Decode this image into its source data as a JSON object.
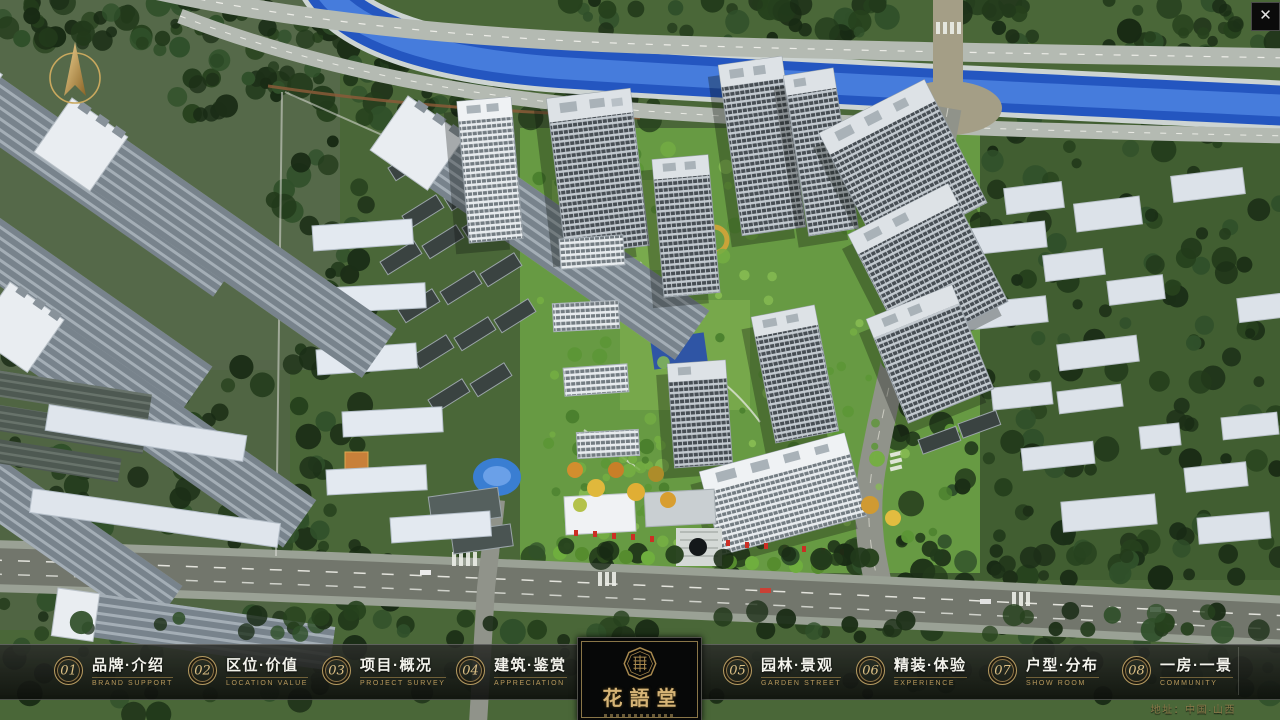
{
  "window": {
    "close_label": "✕"
  },
  "nav": {
    "items": [
      {
        "num": "01",
        "zh": "品牌·介绍",
        "en": "BRAND SUPPORT"
      },
      {
        "num": "02",
        "zh": "区位·价值",
        "en": "LOCATION VALUE"
      },
      {
        "num": "03",
        "zh": "项目·概况",
        "en": "PROJECT SURVEY"
      },
      {
        "num": "04",
        "zh": "建筑·鉴赏",
        "en": "APPRECIATION"
      },
      {
        "num": "05",
        "zh": "园林·景观",
        "en": "GARDEN STREET"
      },
      {
        "num": "06",
        "zh": "精装·体验",
        "en": "EXPERIENCE"
      },
      {
        "num": "07",
        "zh": "户型·分布",
        "en": "SHOW ROOM"
      },
      {
        "num": "08",
        "zh": "一房·一景",
        "en": "COMMUNITY"
      }
    ]
  },
  "logo": {
    "name": "花語堂"
  },
  "footer": {
    "address": "地址：中国·山西"
  },
  "colors": {
    "accent_gold": "#c2a566",
    "river_blue": "#2a5cc4",
    "bar_bg": "#16180f"
  }
}
